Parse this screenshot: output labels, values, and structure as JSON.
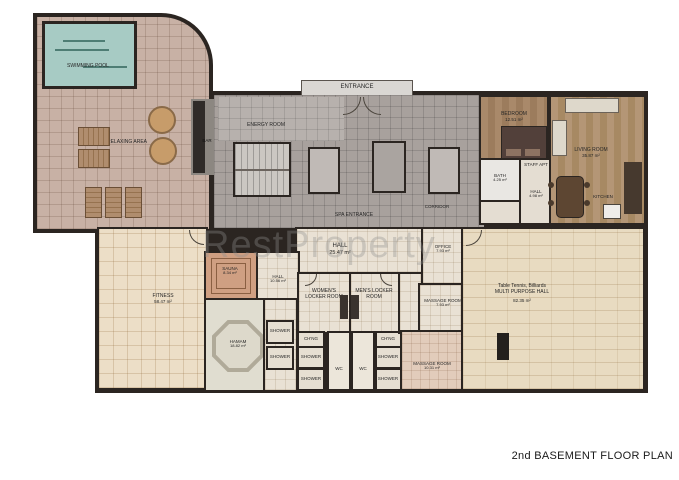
{
  "title": "2nd BASEMENT FLOOR PLAN",
  "watermark": "RestProperty",
  "colors": {
    "wall": "#2b2521",
    "pool": "#a7cbc4",
    "deck": "#c8b1a5",
    "spa_gray": "#a8a19d",
    "cream": "#e9e1d4",
    "wood": "#a9896a",
    "counter_dark": "#46392e"
  },
  "rooms": {
    "swimming_pool": {
      "label": "SWIMMING POOL"
    },
    "relaxing_area": {
      "label": "RELAXING AREA"
    },
    "bar": {
      "label": "BAR"
    },
    "entrance": {
      "label": "ENTRANCE"
    },
    "energy_room": {
      "label": "ENERGY ROOM"
    },
    "spa_entrance": {
      "label": "SPA ENTRANCE"
    },
    "corridor": {
      "label": "CORRIDOR"
    },
    "hall_main": {
      "label": "HALL",
      "area": "25.47 m²"
    },
    "office": {
      "label": "OFFICE",
      "area": "7.93 m²"
    },
    "sauna": {
      "label": "SAUNA",
      "area": "8.34 m²"
    },
    "hall_spa": {
      "label": "HALL",
      "area": "10.56 m²"
    },
    "womens_locker": {
      "label": "WOMEN'S LOCKER ROOM"
    },
    "mens_locker": {
      "label": "MEN'S LOCKER ROOM"
    },
    "massage_room_1": {
      "label": "MASSAGE ROOM",
      "area": "7.93 m²"
    },
    "multi_purpose": {
      "line1": "Table Tennis, Billiards",
      "label": "MULTI PURPOSE HALL",
      "area": "82.35 m²"
    },
    "fitness": {
      "label": "FITNESS",
      "area": "58.47 m²"
    },
    "hamam": {
      "label": "HAMAM",
      "area": "18.82 m²"
    },
    "massage_room_2": {
      "label": "MASSAGE ROOM",
      "area": "10.31 m²"
    },
    "bedroom": {
      "label": "BEDROOM",
      "area": "12.51 m²"
    },
    "living_room": {
      "label": "LIVING ROOM",
      "area": "35.87 m²"
    },
    "bath": {
      "label": "BATH",
      "area": "4.25 m²"
    },
    "staff_apt": {
      "label": "STAFF APT"
    },
    "hall_apt": {
      "label": "HALL",
      "area": "4.98 m²"
    },
    "kitchen": {
      "label": "KITCHEN"
    },
    "chng": {
      "label": "CH'NG"
    },
    "shower": {
      "label": "SHOWER"
    },
    "wc": {
      "label": "WC"
    }
  }
}
